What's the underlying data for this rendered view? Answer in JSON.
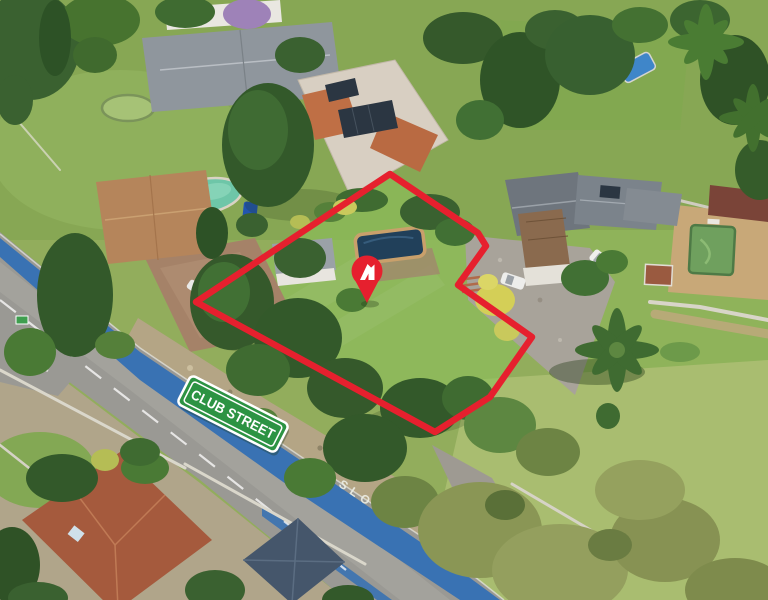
{
  "annotations": {
    "street_sign": {
      "label": "CLUB STREET",
      "bg_color": "#2c9343",
      "text_color": "#ffffff",
      "border_color": "#ffffff"
    },
    "road_marking": {
      "label": "SLOW",
      "paint_color": "#edefe6"
    },
    "property_boundary": {
      "color": "#e6202e"
    },
    "location_pin": {
      "color": "#e6202e",
      "icon": "brand-a-monogram-icon",
      "icon_color": "#ffffff"
    },
    "cycle_lane": {
      "color": "#3470b4"
    }
  }
}
